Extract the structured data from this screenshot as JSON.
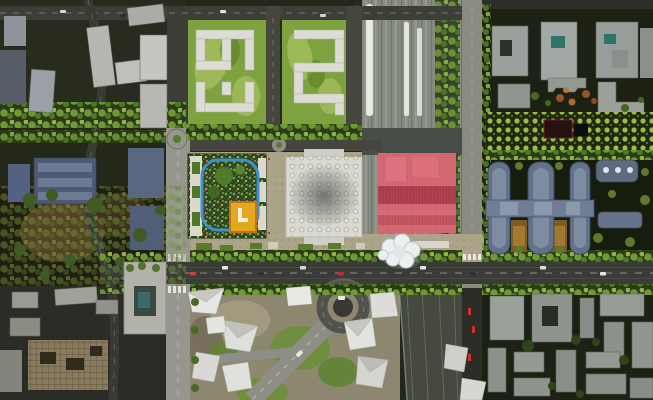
{
  "canvas": {
    "width": 653,
    "height": 400
  },
  "scene": {
    "kind": "aerial-masterplan-rendering",
    "highlighted_block": "station-building-highlight"
  },
  "palette": {
    "base_ground": "#23281b",
    "road_dark": "#3b3b37",
    "road_light": "#96968e",
    "park_green": "#7da23f",
    "park_light": "#a9c261",
    "building_white": "#dcdcd4",
    "rail_gray": "#868c82",
    "trees_dark": "#2c3a19",
    "tree_leaf": "#6f9a33",
    "highlight_red": "#e15968",
    "highlight_red_dark": "#8f1f32",
    "roof_garden_green": "#2c4a1e",
    "running_track_blue": "#3f8fd0",
    "pavilion_yellow": "#e2a81e",
    "east_building_blue": "#64718a",
    "paving_tan": "#aba489",
    "south_ground": "#8d8770",
    "warm_courtyard": "#7a5c26"
  }
}
